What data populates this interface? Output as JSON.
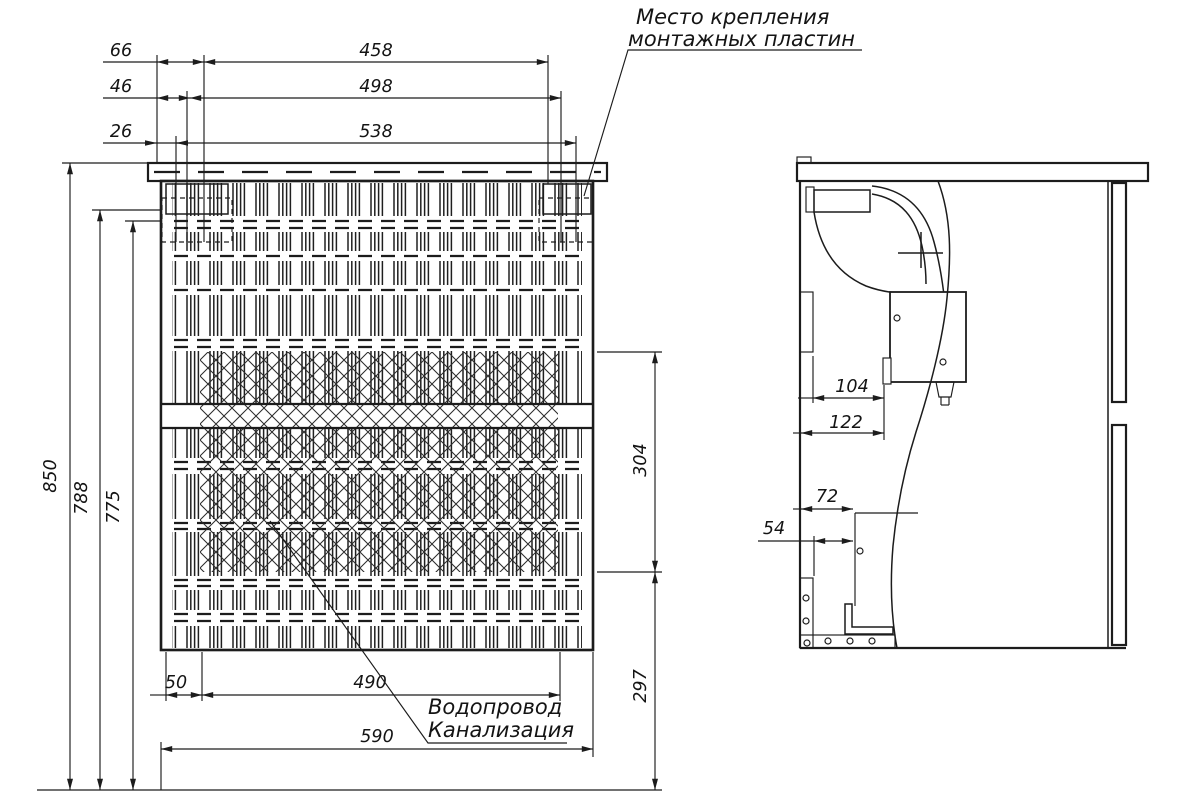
{
  "drawing": {
    "notes": {
      "mounting_line1": "Место крепления",
      "mounting_line2": "монтажных пластин",
      "pipes_line1": "Водопровод",
      "pipes_line2": "Канализация"
    },
    "front": {
      "top": {
        "offset1": "66",
        "span1": "458",
        "offset2": "46",
        "span2": "498",
        "offset3": "26",
        "span3": "538"
      },
      "left": {
        "total": "850",
        "upper": "788",
        "lower": "775"
      },
      "right": {
        "upper": "304",
        "lower": "297"
      },
      "bottom": {
        "offset": "50",
        "span": "490",
        "width": "590"
      }
    },
    "side": {
      "d104": "104",
      "d122": "122",
      "d72": "72",
      "d54": "54"
    },
    "colors": {
      "line": "#1c1c1c",
      "background": "#ffffff"
    }
  }
}
